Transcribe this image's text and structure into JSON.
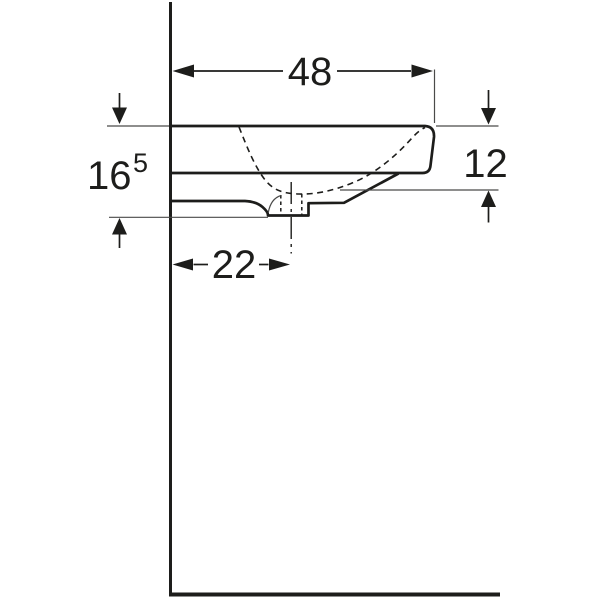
{
  "figure": {
    "dim_width": "48",
    "dim_depth": "12",
    "dim_height_main": "16",
    "dim_height_sup": "5",
    "dim_drain_offset": "22"
  },
  "colors": {
    "line": "#1d1d1b",
    "thin_line": "#4a4a49",
    "background": "#ffffff"
  }
}
